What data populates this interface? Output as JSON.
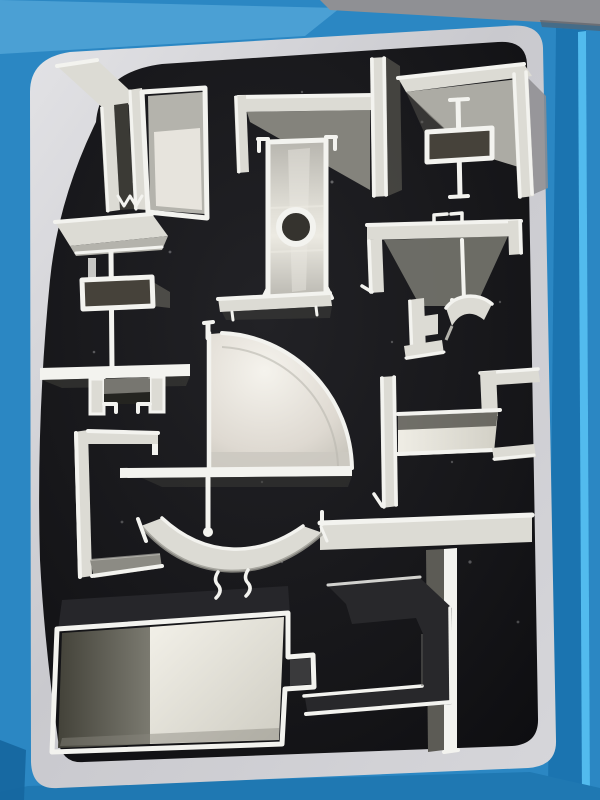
{
  "scene": {
    "type": "photograph",
    "description": "Sample display board of aluminum extrusion profile cross-sections pressed into a black felt backing, set inside a glossy blue painted wooden frame with a light gray liner. Photographed at a slight angle under indoor light.",
    "frame": {
      "look": "glossy blue painted wood",
      "liner": "light gray rounded mat border",
      "backing": "black felt"
    },
    "profile_count": 15
  },
  "profiles": [
    {
      "id": "window-frame-section",
      "label": "Multi-chamber window frame profile",
      "finish": "silver",
      "position": "top-left"
    },
    {
      "id": "corner-angle-left",
      "label": "L corner angle with web",
      "finish": "silver",
      "position": "top-center"
    },
    {
      "id": "corner-angle-right",
      "label": "L corner angle",
      "finish": "silver",
      "position": "top-right"
    },
    {
      "id": "h-connector",
      "label": "H connector with box core",
      "finish": "silver",
      "position": "top-right inset"
    },
    {
      "id": "mullion-round-port",
      "label": "Mullion tube with round port",
      "finish": "silver",
      "position": "upper-center"
    },
    {
      "id": "stem-box-channel",
      "label": "T-stem with box and U-channel",
      "finish": "silver",
      "position": "mid-left"
    },
    {
      "id": "c-bracket",
      "label": "C bracket",
      "finish": "silver",
      "position": "left"
    },
    {
      "id": "quarter-round",
      "label": "Quarter-round corner profile",
      "finish": "silver",
      "position": "center"
    },
    {
      "id": "hook-rail",
      "label": "Hooked top rail",
      "finish": "silver",
      "position": "mid-right"
    },
    {
      "id": "gutter-clips",
      "label": "Small clip / gutter pieces",
      "finish": "silver",
      "position": "right of center"
    },
    {
      "id": "side-channel",
      "label": "Side channel with steps",
      "finish": "silver",
      "position": "right"
    },
    {
      "id": "tee-profile",
      "label": "Large T profile",
      "finish": "silver",
      "position": "bottom-right"
    },
    {
      "id": "dark-c-channel",
      "label": "Dark anodized C channel",
      "finish": "dark",
      "position": "bottom-center"
    },
    {
      "id": "box-tube-large",
      "label": "Large box tube with side tab",
      "finish": "silver",
      "position": "bottom-left"
    },
    {
      "id": "curved-arch",
      "label": "Curved arch strip with feet",
      "finish": "silver",
      "position": "lower-center"
    }
  ],
  "palette": {
    "frame_blue": "#2b87c3",
    "frame_blue_light": "#4fa3d6",
    "frame_blue_deep": "#1b74b0",
    "frame_blue_bottom": "#1f78b2",
    "frame_highlight": "#52bbee",
    "outer_gray": "#8f9094",
    "mat_gray": "#cdced2",
    "mat_gray_light": "#dfdfe3",
    "board_black": "#141417",
    "alu_bright": "#f3f3ef",
    "alu_light": "#dcdbd4",
    "alu_mid": "#b4b3ac",
    "alu_shade": "#8c8b84",
    "alu_dark": "#57564f",
    "interior_dark": "#3b3a35",
    "interior_brown": "#46423a",
    "piece_dark": "#28282b",
    "white_face": "#ece9e2"
  }
}
